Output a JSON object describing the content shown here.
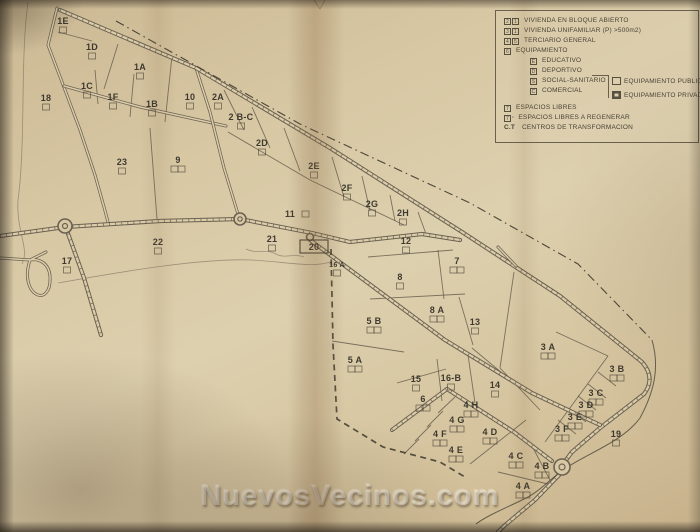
{
  "watermark": "NuevosVecinos.com",
  "legend": {
    "rows": [
      {
        "boxes": [
          "2",
          "1"
        ],
        "label": "VIVIENDA EN BLOQUE ABIERTO"
      },
      {
        "boxes": [
          "3",
          "1"
        ],
        "label": "VIVIENDA UNIFAMILIAR  (P) >500m2)"
      },
      {
        "boxes": [
          "4",
          "5"
        ],
        "label": "TERCIARIO GENERAL"
      },
      {
        "boxes": [
          "6"
        ],
        "label": "EQUIPAMIENTO"
      }
    ],
    "equipment": [
      {
        "key": "E",
        "label": "EDUCATIVO"
      },
      {
        "key": "D",
        "label": "DEPORTIVO"
      },
      {
        "key": "S",
        "label": "SOCIAL-SANITARIO"
      },
      {
        "key": "C",
        "label": "COMERCIAL"
      }
    ],
    "equipment_types": [
      {
        "kind": "publico",
        "label": "EQUIPAMIENTO PUBLICO"
      },
      {
        "kind": "privado",
        "label": "EQUIPAMIENTO PRIVADO"
      }
    ],
    "free_rows": [
      {
        "boxes": [
          "7"
        ],
        "suffix": "",
        "prefix": "",
        "label": "ESPACIOS LIBRES"
      },
      {
        "boxes": [
          "7"
        ],
        "suffix": "·",
        "prefix": "",
        "label": "ESPACIOS LIBRES A REGENERAR"
      },
      {
        "boxes": [],
        "suffix": "",
        "prefix": "C.T",
        "label": "CENTROS DE TRANSFORMACION"
      }
    ]
  },
  "parcels": [
    {
      "label": "1E",
      "x": 63,
      "y": 21,
      "boxes": 1
    },
    {
      "label": "1D",
      "x": 92,
      "y": 47,
      "boxes": 1
    },
    {
      "label": "1A",
      "x": 140,
      "y": 67,
      "boxes": 1
    },
    {
      "label": "1C",
      "x": 87,
      "y": 86,
      "boxes": 1
    },
    {
      "label": "1F",
      "x": 113,
      "y": 97,
      "boxes": 1
    },
    {
      "label": "1B",
      "x": 152,
      "y": 104,
      "boxes": 1
    },
    {
      "label": "10",
      "x": 190,
      "y": 97,
      "boxes": 1
    },
    {
      "label": "18",
      "x": 46,
      "y": 98,
      "boxes": 1
    },
    {
      "label": "2A",
      "x": 218,
      "y": 97,
      "boxes": 1
    },
    {
      "label": "2 B-C",
      "x": 241,
      "y": 117,
      "boxes": 1
    },
    {
      "label": "2D",
      "x": 262,
      "y": 143,
      "boxes": 1
    },
    {
      "label": "2E",
      "x": 314,
      "y": 166,
      "boxes": 1
    },
    {
      "label": "2F",
      "x": 347,
      "y": 188,
      "boxes": 1
    },
    {
      "label": "2G",
      "x": 372,
      "y": 204,
      "boxes": 1
    },
    {
      "label": "2H",
      "x": 403,
      "y": 213,
      "boxes": 1
    },
    {
      "label": "23",
      "x": 122,
      "y": 162,
      "boxes": 1
    },
    {
      "label": "9",
      "x": 178,
      "y": 160,
      "boxes": 2
    },
    {
      "label": "11",
      "x": 290,
      "y": 214,
      "boxes": 1,
      "side": "right"
    },
    {
      "label": "22",
      "x": 158,
      "y": 242,
      "boxes": 1
    },
    {
      "label": "21",
      "x": 272,
      "y": 239,
      "boxes": 1
    },
    {
      "label": "20",
      "x": 314,
      "y": 247,
      "boxes": 0,
      "framed": true
    },
    {
      "label": "17",
      "x": 67,
      "y": 261,
      "boxes": 1
    },
    {
      "label": "16 A",
      "x": 337,
      "y": 264,
      "boxes": 1,
      "small": true
    },
    {
      "label": "12",
      "x": 406,
      "y": 241,
      "boxes": 1
    },
    {
      "label": "8",
      "x": 400,
      "y": 277,
      "boxes": 1
    },
    {
      "label": "7",
      "x": 457,
      "y": 261,
      "boxes": 2
    },
    {
      "label": "8 A",
      "x": 437,
      "y": 310,
      "boxes": 2
    },
    {
      "label": "13",
      "x": 475,
      "y": 322,
      "boxes": 1
    },
    {
      "label": "5 B",
      "x": 374,
      "y": 321,
      "boxes": 2
    },
    {
      "label": "5 A",
      "x": 355,
      "y": 360,
      "boxes": 2
    },
    {
      "label": "15",
      "x": 416,
      "y": 379,
      "boxes": 1
    },
    {
      "label": "16-B",
      "x": 451,
      "y": 378,
      "boxes": 1
    },
    {
      "label": "14",
      "x": 495,
      "y": 385,
      "boxes": 1
    },
    {
      "label": "3 A",
      "x": 548,
      "y": 347,
      "boxes": 2
    },
    {
      "label": "6",
      "x": 423,
      "y": 399,
      "boxes": 2
    },
    {
      "label": "4 H",
      "x": 471,
      "y": 405,
      "boxes": 2
    },
    {
      "label": "3 B",
      "x": 617,
      "y": 369,
      "boxes": 2
    },
    {
      "label": "3 C",
      "x": 596,
      "y": 393,
      "boxes": 2
    },
    {
      "label": "3 D",
      "x": 586,
      "y": 405,
      "boxes": 2
    },
    {
      "label": "4 G",
      "x": 457,
      "y": 420,
      "boxes": 2
    },
    {
      "label": "3 E",
      "x": 575,
      "y": 417,
      "boxes": 2
    },
    {
      "label": "4 F",
      "x": 440,
      "y": 434,
      "boxes": 2
    },
    {
      "label": "3 F",
      "x": 562,
      "y": 429,
      "boxes": 2
    },
    {
      "label": "4 D",
      "x": 490,
      "y": 432,
      "boxes": 2
    },
    {
      "label": "19",
      "x": 616,
      "y": 434,
      "boxes": 1
    },
    {
      "label": "4 E",
      "x": 456,
      "y": 450,
      "boxes": 2
    },
    {
      "label": "4 C",
      "x": 516,
      "y": 456,
      "boxes": 2
    },
    {
      "label": "4 B",
      "x": 542,
      "y": 466,
      "boxes": 2
    },
    {
      "label": "4 A",
      "x": 523,
      "y": 486,
      "boxes": 2
    }
  ]
}
